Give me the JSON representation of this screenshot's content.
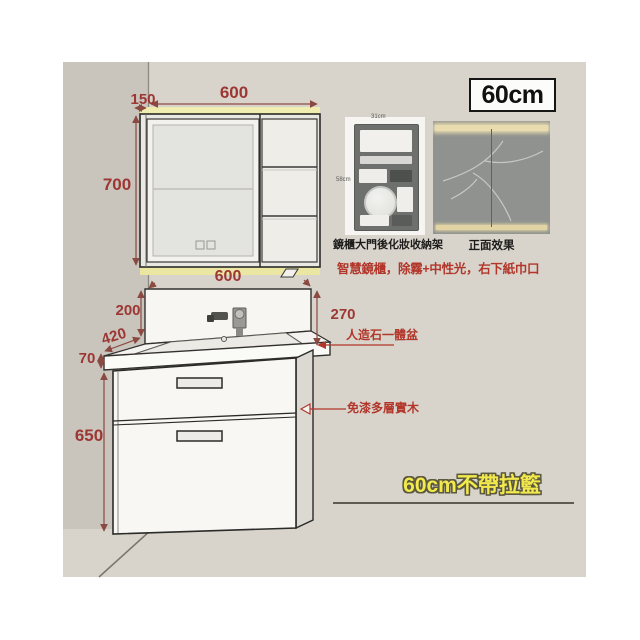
{
  "badge": {
    "size": "60cm"
  },
  "mirror_cabinet": {
    "dims": {
      "depth": "150",
      "width": "600",
      "height": "700"
    }
  },
  "vanity": {
    "dims": {
      "counter_width": "600",
      "splash_height_left": "200",
      "splash_height_right": "270",
      "counter_depth": "420",
      "counter_height": "70",
      "cabinet_height": "650"
    }
  },
  "photos": {
    "left": {
      "caption": "鏡櫃大門後化妝收納架",
      "width_label": "31cm",
      "height_label": "58cm"
    },
    "right": {
      "caption": "正面效果"
    }
  },
  "notes": {
    "smart_mirror": "智慧鏡櫃，除霧+中性光，右下紙巾口",
    "basin": "人造石一體盆",
    "wood": "免漆多層實木",
    "variant": "60cm不帶拉籃"
  },
  "colors": {
    "dimension_text": "#9c3733",
    "note_text": "#b2362a",
    "variant_text": "#f2e94d",
    "wall": "#d8d4cc",
    "wall_shade": "#c9c4bc",
    "light_strip": "#efedb0"
  }
}
